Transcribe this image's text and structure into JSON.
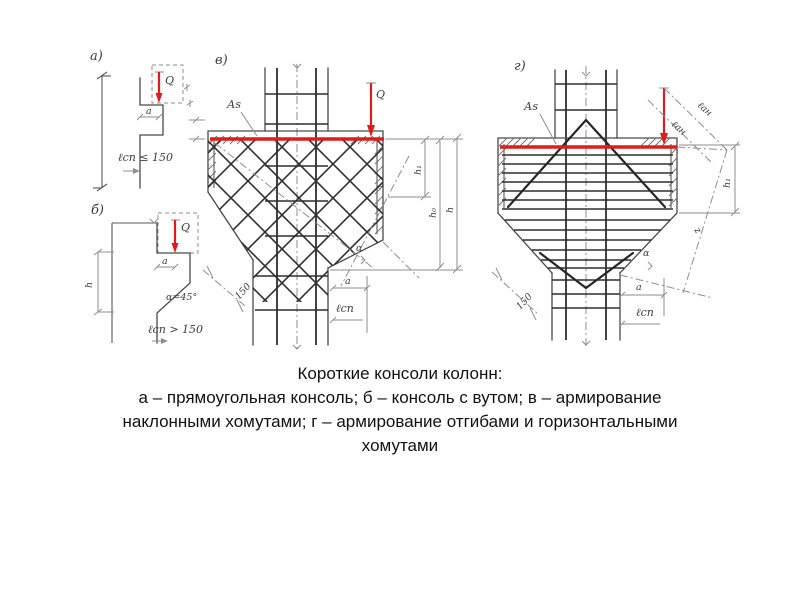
{
  "slide": {
    "background": "#ffffff"
  },
  "colors": {
    "ink": "#4a4a4a",
    "ink_light": "#8e8e8e",
    "rebar": "#2e2e2e",
    "accent_red": "#df1c1c",
    "caption_text": "#111111"
  },
  "caption": {
    "title": "Короткие консоли колонн:",
    "line2": "а – прямоугольная консоль; б – консоль с вутом; в – армирование",
    "line3": "наклонными хомутами; г – армирование отгибами и горизонтальными",
    "line4": "хомутами"
  },
  "panel_a": {
    "label": "а)",
    "force": "Q",
    "dim_a": "a",
    "bearing": "ℓсп ≤ 150"
  },
  "panel_b": {
    "label": "б)",
    "force": "Q",
    "dim_a": "a",
    "height": "h",
    "angle": "α=45°",
    "bearing": "ℓсп > 150"
  },
  "panel_v": {
    "label": "в)",
    "force": "Q",
    "rebar_area": "Аs",
    "dim_a": "a",
    "bearing": "ℓсп",
    "slope_len": "150",
    "dim_h1": "h₁",
    "dim_h0": "h₀",
    "dim_h": "h",
    "lever_arm": "z",
    "angle": "α"
  },
  "panel_g": {
    "label": "г)",
    "rebar_area": "Аs",
    "dim_a": "a",
    "bearing": "ℓсп",
    "slope_len": "150",
    "dim_h1": "h₁",
    "lever_arm": "z",
    "angle": "α",
    "anchor_top": "ℓан",
    "anchor_bottom": "ℓан"
  }
}
